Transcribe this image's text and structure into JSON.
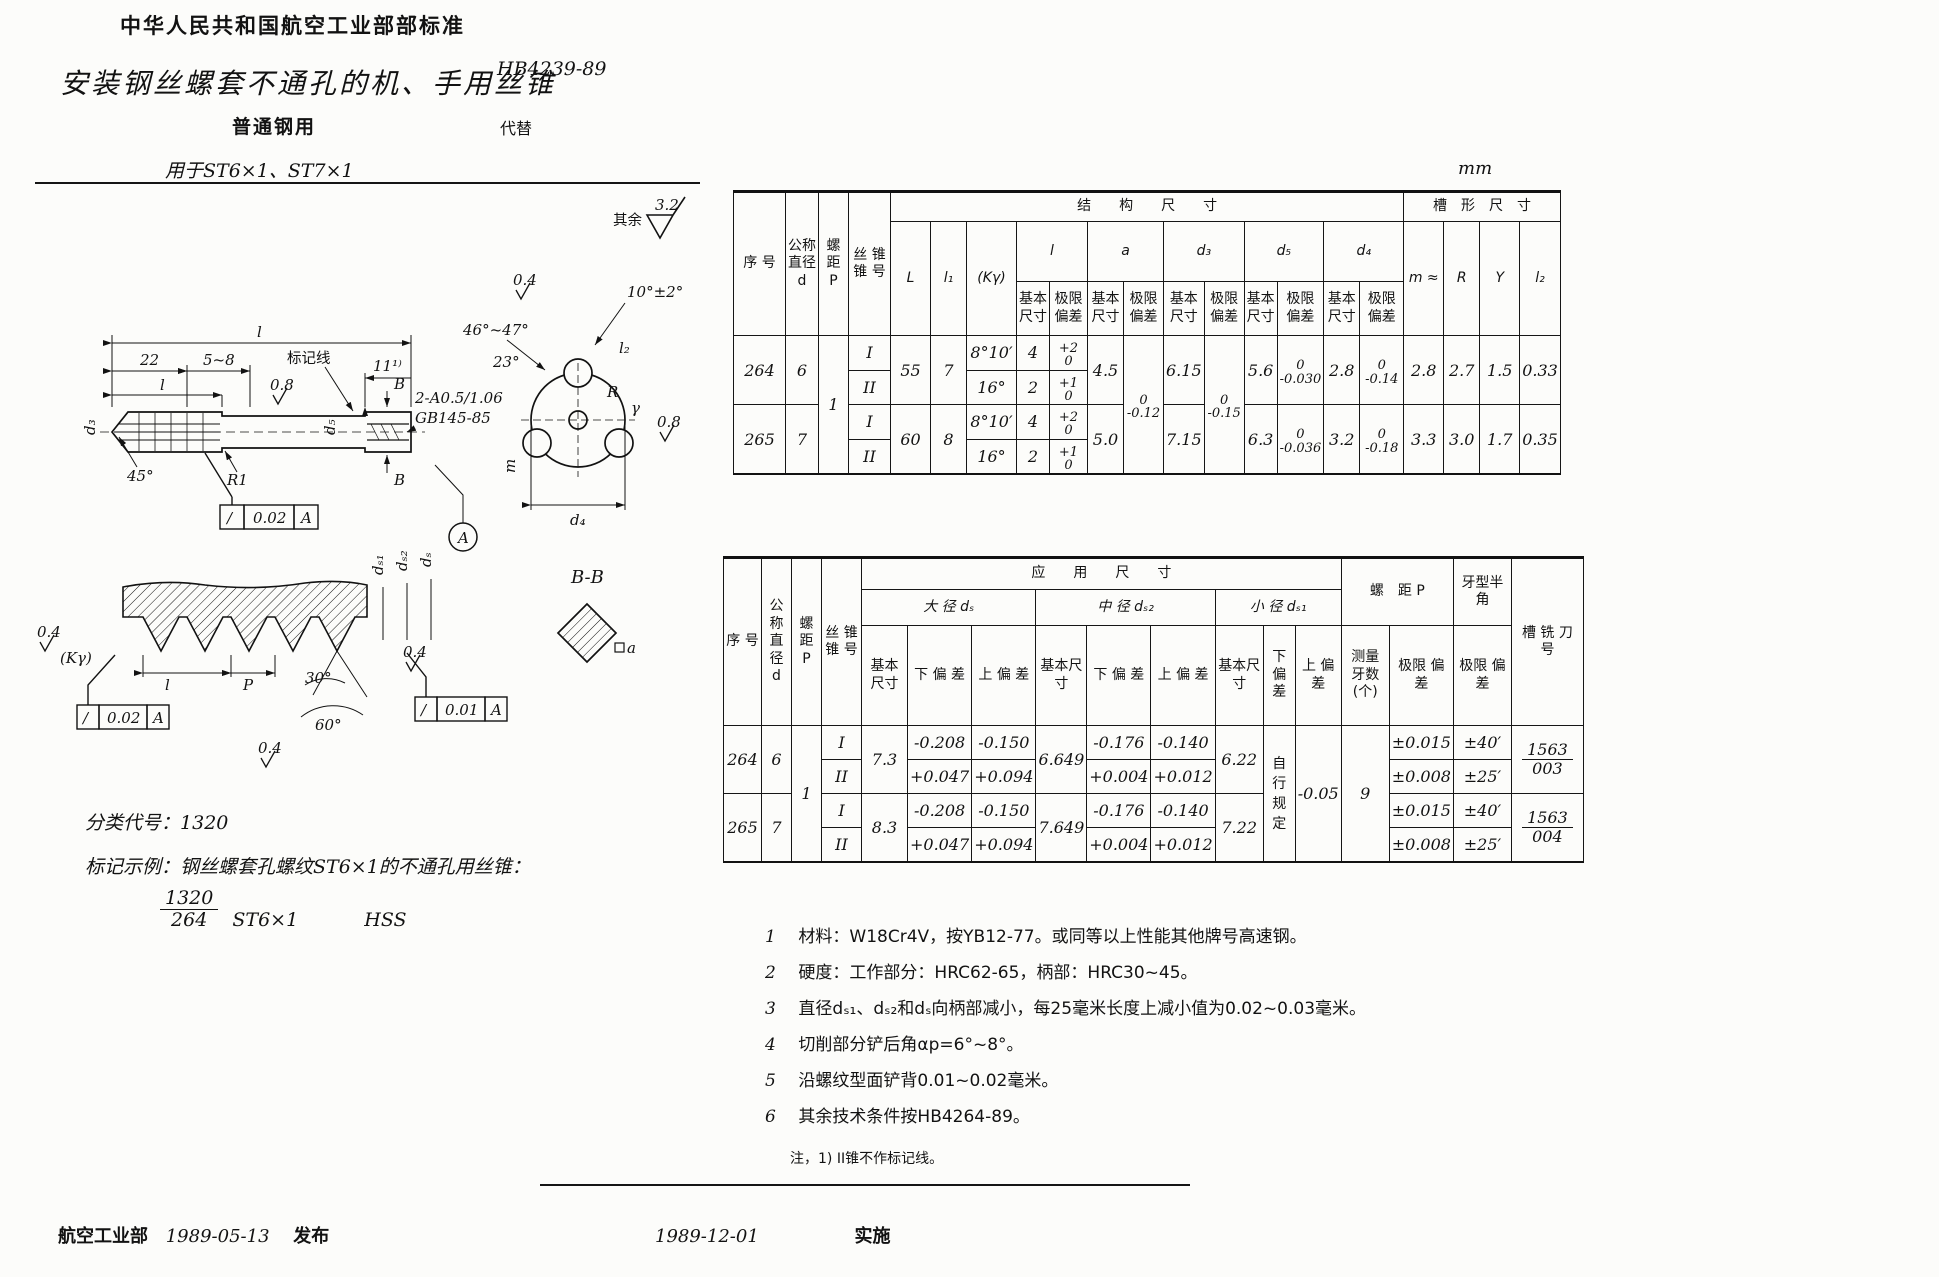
{
  "page": {
    "standard_header": "中华人民共和国航空工业部部标准",
    "title": "安装钢丝螺套不通孔的机、手用丝锥",
    "std_number": "HB4239-89",
    "subtitle": "普通钢用",
    "supersedes": "代替",
    "applies_to": "用于ST6×1、ST7×1",
    "unit": "mm",
    "class_code_label": "分类代号：",
    "class_code": "1320",
    "marking_example_label": "标记示例：钢丝螺套孔螺纹ST6×1的不通孔用丝锥：",
    "marking_frac_top": "1320",
    "marking_frac_bot": "264",
    "marking_spec": "ST6×1",
    "marking_material": "HSS",
    "table_note": "注，1) II锥不作标记线。",
    "footer_org": "航空工业部",
    "footer_issue_date": "1989-05-13",
    "footer_issue": "发布",
    "footer_impl_date": "1989-12-01",
    "footer_impl": "实施"
  },
  "notes": [
    {
      "num": "1",
      "text": "材料：W18Cr4V，按YB12-77。或同等以上性能其他牌号高速钢。"
    },
    {
      "num": "2",
      "text": "硬度：工作部分：HRC62-65，柄部：HRC30~45。"
    },
    {
      "num": "3",
      "text": "直径dₛ₁、dₛ₂和dₛ向柄部减小，每25毫米长度上减小值为0.02~0.03毫米。"
    },
    {
      "num": "4",
      "text": "切削部分铲后角αp=6°~8°。"
    },
    {
      "num": "5",
      "text": "沿螺纹型面铲背0.01~0.02毫米。"
    },
    {
      "num": "6",
      "text": "其余技术条件按HB4264-89。"
    }
  ],
  "t1": {
    "g_struct": "结　　构　　尺　　寸",
    "g_groove": "槽　形　尺　寸",
    "h_seq": "序 号",
    "h_d": "公称直径 d",
    "h_P": "螺 距 P",
    "h_taper": "丝 锥 锥 号",
    "h_L": "L",
    "h_l1": "l₁",
    "h_K": "(Kγ)",
    "h_l": "l",
    "h_a": "a",
    "h_d3": "d₃",
    "h_d5": "d₅",
    "h_d4": "d₄",
    "h_basic": "基本 尺寸",
    "h_dev": "极限 偏差",
    "h_m": "m ≈",
    "h_R": "R",
    "h_Y": "Y",
    "h_l2": "l₂",
    "P": "1",
    "a_dev": {
      "t": "0",
      "b": "-0.12"
    },
    "d3_dev": {
      "t": "0",
      "b": "-0.15"
    },
    "r264": {
      "seq": "264",
      "d": "6",
      "tI": "I",
      "tII": "II",
      "L": "55",
      "l1": "7",
      "K_I": "8°10′",
      "K_II": "16°",
      "l_I": "4",
      "l_II": "2",
      "lde_I": {
        "t": "+2",
        "b": "0"
      },
      "lde_II": {
        "t": "+1",
        "b": "0"
      },
      "a": "4.5",
      "d3": "6.15",
      "d5": "5.6",
      "d5_dev": {
        "t": "0",
        "b": "-0.030"
      },
      "d4": "2.8",
      "d4_dev": {
        "t": "0",
        "b": "-0.14"
      },
      "m": "2.8",
      "R": "2.7",
      "Y": "1.5",
      "l2": "0.33"
    },
    "r265": {
      "seq": "265",
      "d": "7",
      "tI": "I",
      "tII": "II",
      "L": "60",
      "l1": "8",
      "K_I": "8°10′",
      "K_II": "16°",
      "l_I": "4",
      "l_II": "2",
      "lde_I": {
        "t": "+2",
        "b": "0"
      },
      "lde_II": {
        "t": "+1",
        "b": "0"
      },
      "a": "5.0",
      "d3": "7.15",
      "d5": "6.3",
      "d5_dev": {
        "t": "0",
        "b": "-0.036"
      },
      "d4": "3.2",
      "d4_dev": {
        "t": "0",
        "b": "-0.18"
      },
      "m": "3.3",
      "R": "3.0",
      "Y": "1.7",
      "l2": "0.35"
    }
  },
  "t2": {
    "g_app": "应　　用　　尺　　寸",
    "h_seq": "序 号",
    "h_d": "公称直径 d",
    "h_P": "螺 距 P",
    "h_taper": "丝 锥 锥 号",
    "g_major": "大 径 dₛ",
    "g_middle": "中 径 dₛ₂",
    "g_minor": "小 径 dₛ₁",
    "g_pitch": "螺　距 P",
    "g_half": "牙型半角",
    "h_half_dev": "极限 偏差",
    "h_cutter": "槽 铣 刀 号",
    "h_basic": "基本尺寸",
    "h_lower": "下 偏 差",
    "h_upper": "上 偏 差",
    "h_teeth": "测量 牙数 (个)",
    "h_dev": "极限 偏差",
    "P": "1",
    "teeth": "9",
    "minor_lower": "自 行 规 定",
    "minor_upper": "-0.05",
    "r264": {
      "seq": "264",
      "d": "6",
      "tI": "I",
      "tII": "II",
      "major": "7.3",
      "maj_lo_I": "-0.208",
      "maj_up_I": "-0.150",
      "maj_lo_II": "+0.047",
      "maj_up_II": "+0.094",
      "mid": "6.649",
      "mid_lo_I": "-0.176",
      "mid_up_I": "-0.140",
      "mid_lo_II": "+0.004",
      "mid_up_II": "+0.012",
      "minor": "6.22",
      "pdev_I": "±0.015",
      "pdev_II": "±0.008",
      "half_I": "±40′",
      "half_II": "±25′",
      "cutter_t": "1563",
      "cutter_b": "003"
    },
    "r265": {
      "seq": "265",
      "d": "7",
      "tI": "I",
      "tII": "II",
      "major": "8.3",
      "maj_lo_I": "-0.208",
      "maj_up_I": "-0.150",
      "maj_lo_II": "+0.047",
      "maj_up_II": "+0.094",
      "mid": "7.649",
      "mid_lo_I": "-0.176",
      "mid_up_I": "-0.140",
      "mid_lo_II": "+0.004",
      "mid_up_II": "+0.012",
      "minor": "7.22",
      "pdev_I": "±0.015",
      "pdev_II": "±0.008",
      "half_I": "±40′",
      "half_II": "±25′",
      "cutter_t": "1563",
      "cutter_b": "004"
    }
  },
  "drawing": {
    "rough_other": "其余",
    "rough_other_v": "3.2",
    "dim_l": "l",
    "dim_22": "22",
    "dim_58": "5~8",
    "marking": "标记线",
    "dim_11": "11¹⁾",
    "r08": "0.8",
    "r04": "0.4",
    "a10": "10°±2°",
    "a46": "46°~47°",
    "a23": "23°",
    "l2": "l₂",
    "R": "R",
    "gamma": "γ",
    "m": "m",
    "d4": "d₄",
    "d3": "d₃",
    "d5": "d₅",
    "a45": "45°",
    "R1": "R1",
    "cs1": "2-A0.5/1.06",
    "cs2": "GB145-85",
    "tol_sym": "/",
    "tol_002": "0.02",
    "tol_001": "0.01",
    "datum": "A",
    "B": "B",
    "BB": "B-B",
    "sq_a": "a",
    "ds1": "dₛ₁",
    "ds2": "dₛ₂",
    "ds": "dₛ",
    "P": "P",
    "a30": "30°",
    "a60": "60°",
    "Kg": "(Kγ)"
  }
}
